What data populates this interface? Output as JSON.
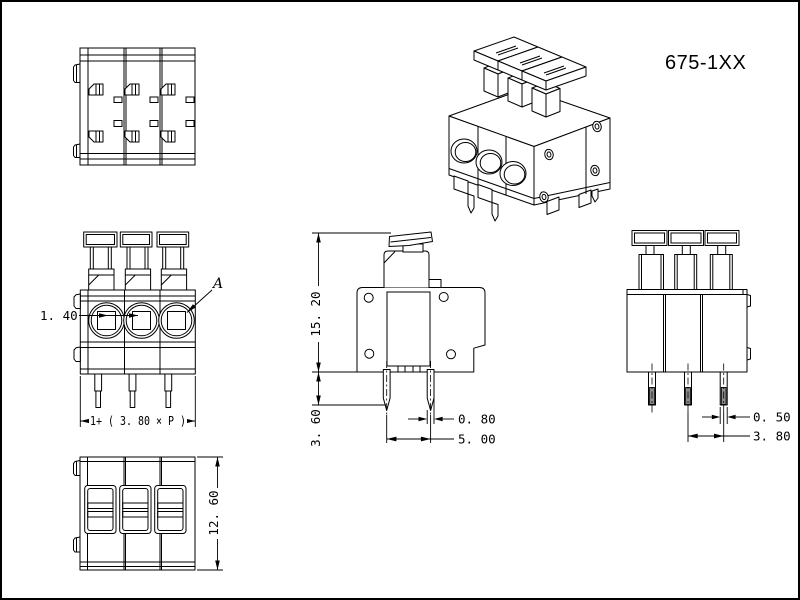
{
  "product": {
    "part_number": "675-1XX"
  },
  "views": {
    "front": {
      "detail_label": "A",
      "dim_wire_opening": "1. 40",
      "dim_total_width": "1+ ( 3. 80 × P )"
    },
    "side": {
      "dim_total_height": "15. 20",
      "dim_pin_protrusion": "3. 60",
      "dim_pin_width": "0. 80",
      "dim_pin_spacing": "5. 00"
    },
    "rear": {
      "dim_pin_thickness": "0. 50",
      "dim_pole_pitch": "3. 80"
    },
    "bottom": {
      "dim_body_depth": "12. 60"
    }
  },
  "colors": {
    "line": "#000000",
    "background": "#ffffff",
    "pin_tip_fill": "#8f8f8f"
  }
}
